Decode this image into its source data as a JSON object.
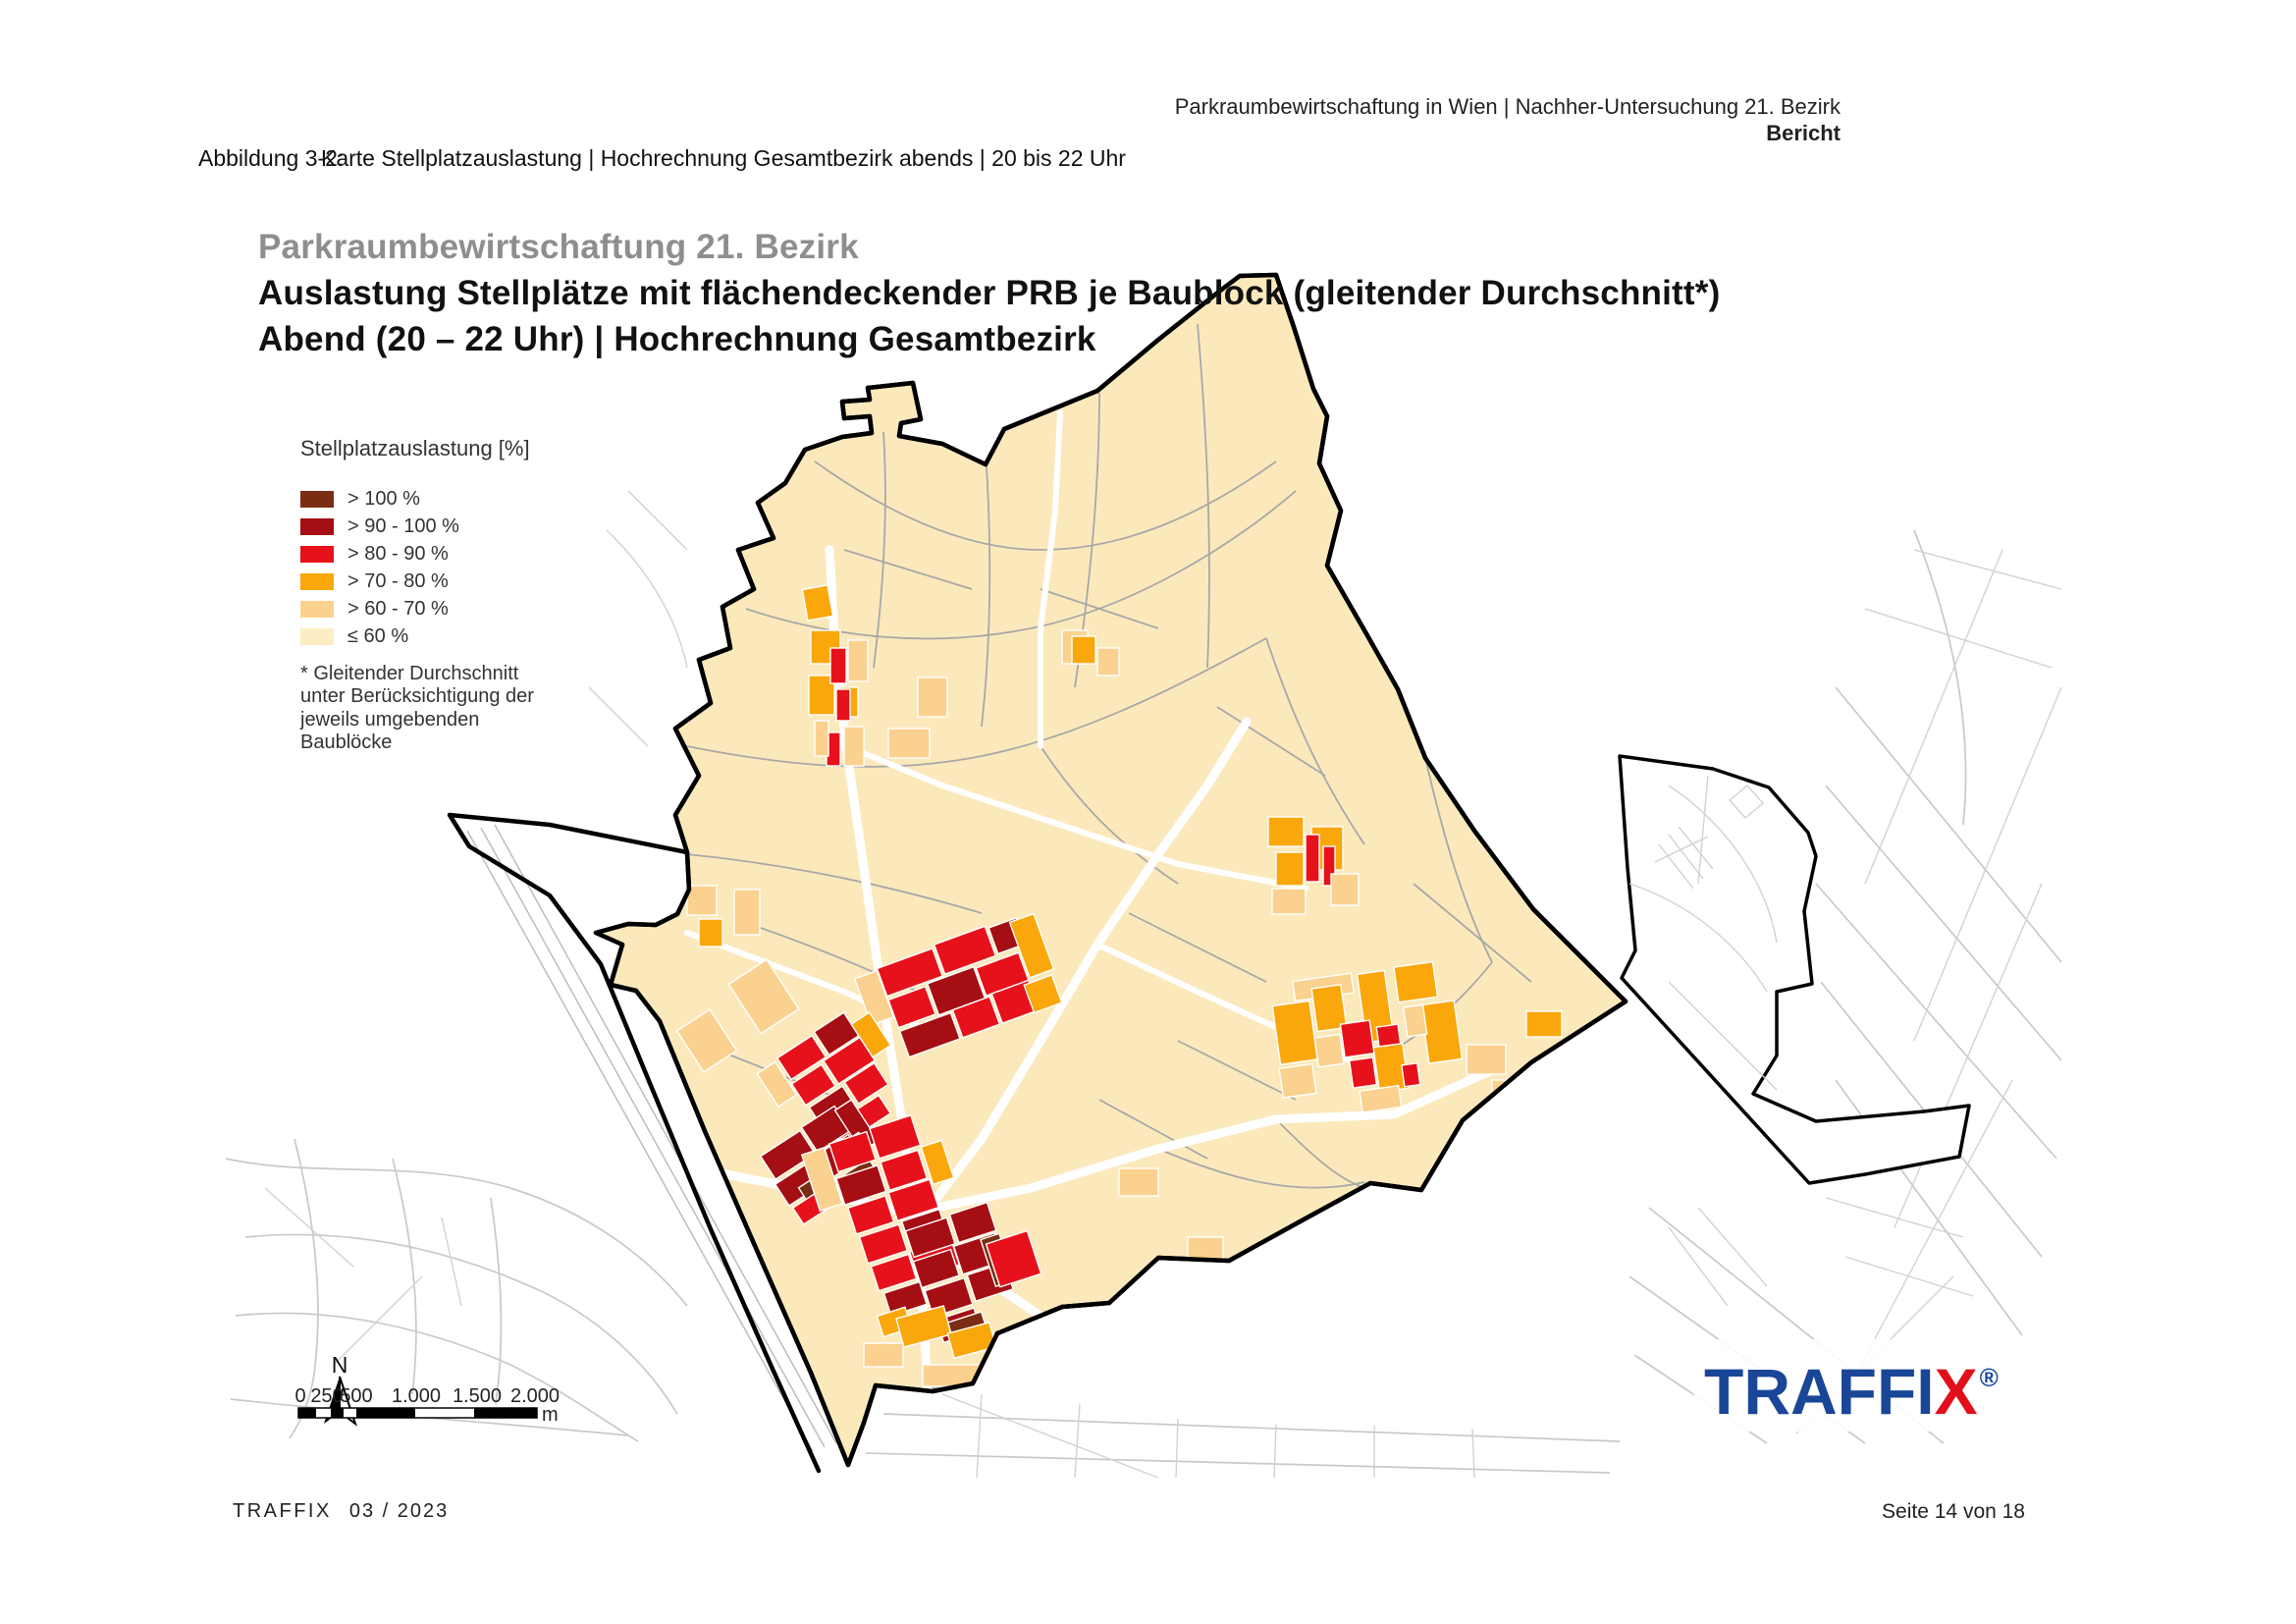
{
  "header": {
    "line1": "Parkraumbewirtschaftung in Wien | Nachher-Untersuchung 21. Bezirk",
    "line2": "Bericht"
  },
  "figure_caption": {
    "label": "Abbildung 3-2:",
    "text": "Karte Stellplatzauslastung | Hochrechnung Gesamtbezirk abends | 20 bis 22 Uhr"
  },
  "map_title": {
    "line1": "Parkraumbewirtschaftung 21. Bezirk",
    "line2": "Auslastung Stellplätze mit flächendeckender PRB je Baublock (gleitender Durchschnitt*)",
    "line3": "Abend (20 – 22 Uhr) | Hochrechnung Gesamtbezirk",
    "line1_color": "#8E8E8E"
  },
  "legend": {
    "title": "Stellplatzauslastung [%]",
    "items": [
      {
        "label": "> 100 %",
        "color": "#7A2D13"
      },
      {
        "label": "> 90 - 100 %",
        "color": "#A50E13"
      },
      {
        "label": "> 80 - 90 %",
        "color": "#E7111B"
      },
      {
        "label": "> 70 - 80 %",
        "color": "#F9A70B"
      },
      {
        "label": "> 60 - 70 %",
        "color": "#FAD18E"
      },
      {
        "label": "≤ 60 %",
        "color": "#FCEDC4"
      }
    ],
    "footnote_lines": [
      "* Gleitender Durchschnitt",
      "unter Berücksichtigung der",
      "jeweils umgebenden",
      "Baublöcke"
    ]
  },
  "map": {
    "north_label": "N",
    "district_fill": "#FBE9BC",
    "boundary_color": "#000000",
    "scalebar": {
      "ticks": [
        "0",
        "250",
        "500",
        "1.000",
        "1.500",
        "2.000"
      ],
      "unit": "m"
    }
  },
  "logo": {
    "blue_text": "TRAFFI",
    "red_text": "X",
    "reg": "®",
    "blue": "#1A4697",
    "red": "#E30E1B"
  },
  "footer": {
    "brand": "TRAFFIX",
    "date": "03 / 2023",
    "page": "Seite 14 von 18"
  }
}
